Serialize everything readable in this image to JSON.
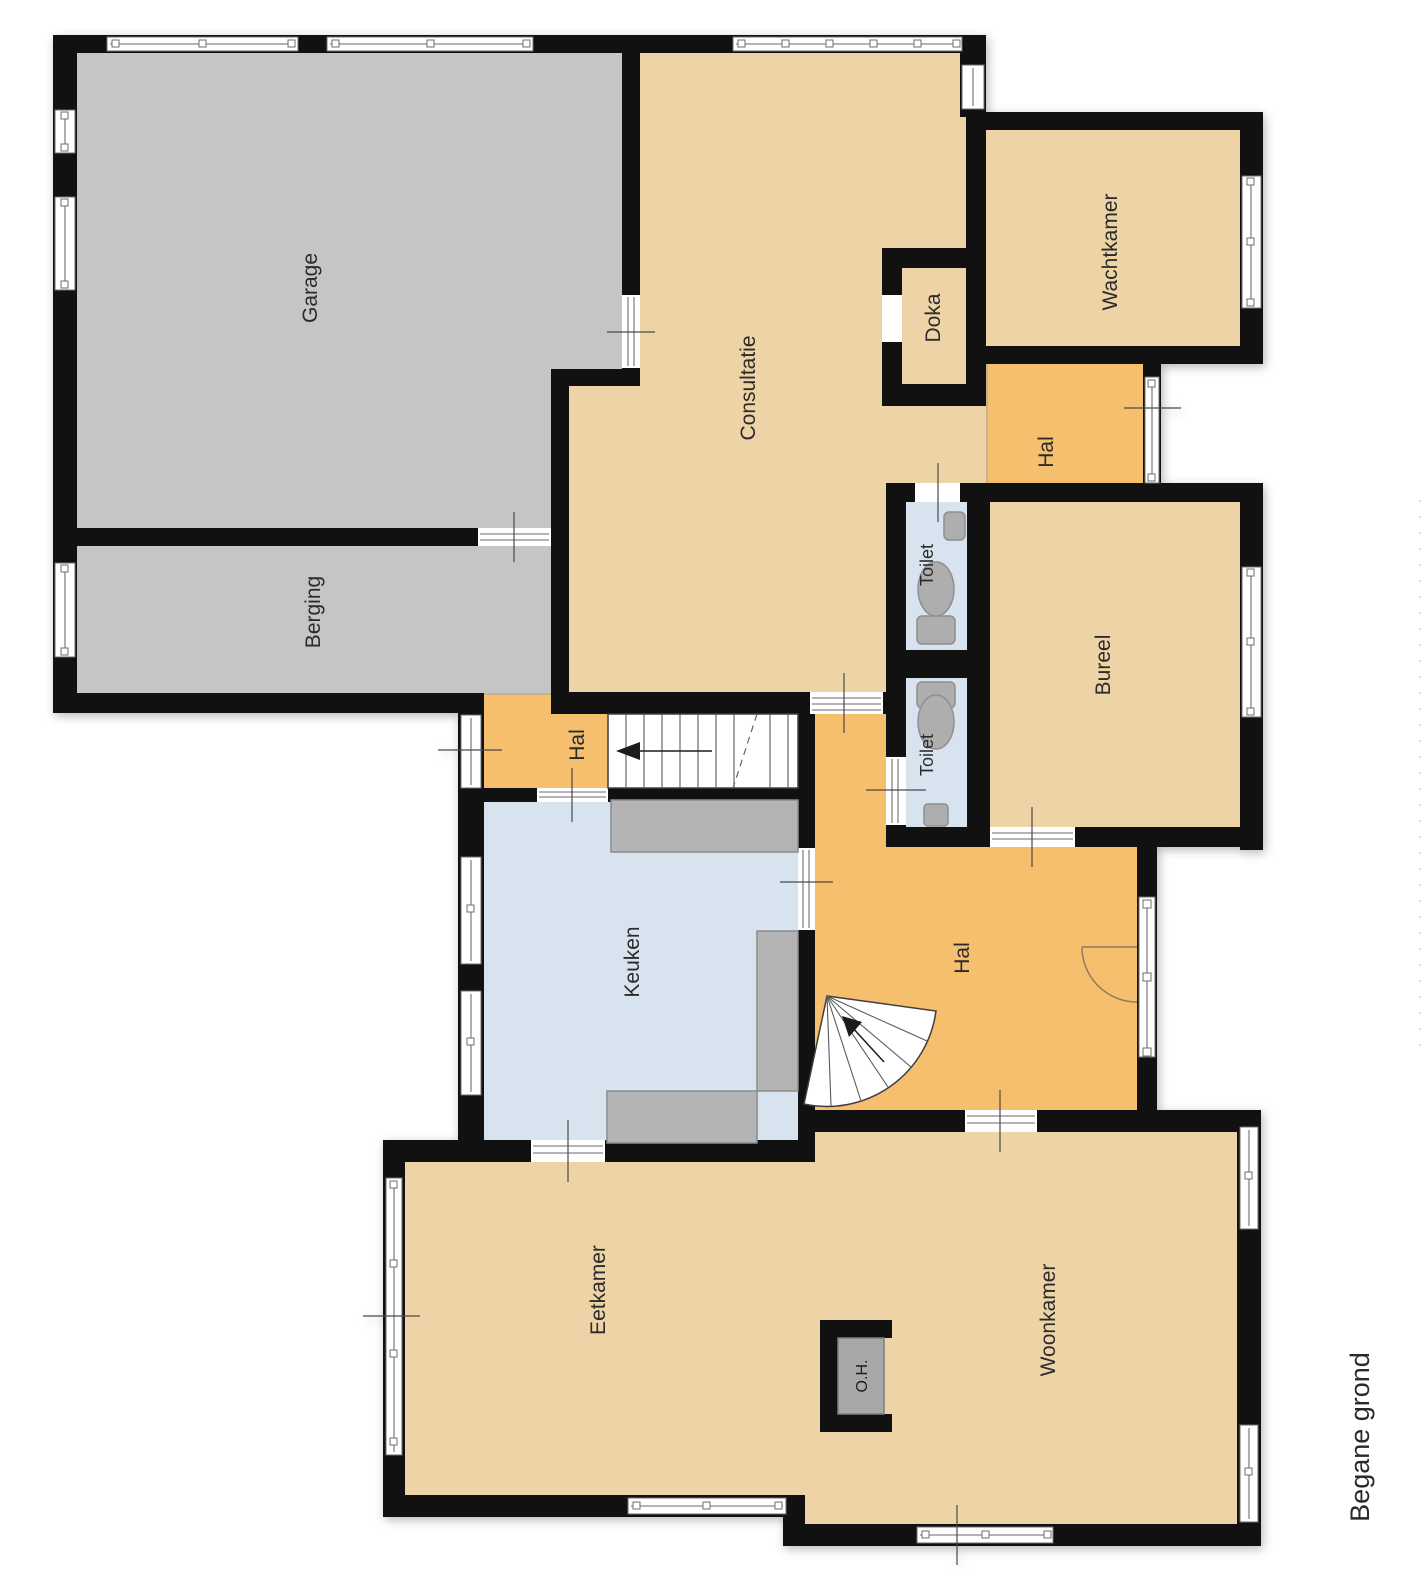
{
  "floor_plan": {
    "title": "Begane grond",
    "rooms": {
      "garage": {
        "label": "Garage"
      },
      "berging": {
        "label": "Berging"
      },
      "consultatie": {
        "label": "Consultatie"
      },
      "doka": {
        "label": "Doka"
      },
      "wachtkamer": {
        "label": "Wachtkamer"
      },
      "hal_boven": {
        "label": "Hal"
      },
      "toilet_1": {
        "label": "Toilet"
      },
      "toilet_2": {
        "label": "Toilet"
      },
      "bureel": {
        "label": "Bureel"
      },
      "hal_klein": {
        "label": "Hal"
      },
      "keuken": {
        "label": "Keuken"
      },
      "hal_centraal": {
        "label": "Hal"
      },
      "eetkamer": {
        "label": "Eetkamer"
      },
      "woonkamer": {
        "label": "Woonkamer"
      },
      "openhaard": {
        "label": "O.H."
      }
    },
    "colors": {
      "wall": "#111111",
      "room_gray": "#c5c4c6",
      "room_tan": "#eed3a6",
      "room_orange": "#f6bf6e",
      "room_blue": "#d7e3ef",
      "counter": "#b5b4b4",
      "fixture": "#aeaeae",
      "window_rail": "#9b9b9b",
      "text": "#2b2b2b"
    }
  }
}
